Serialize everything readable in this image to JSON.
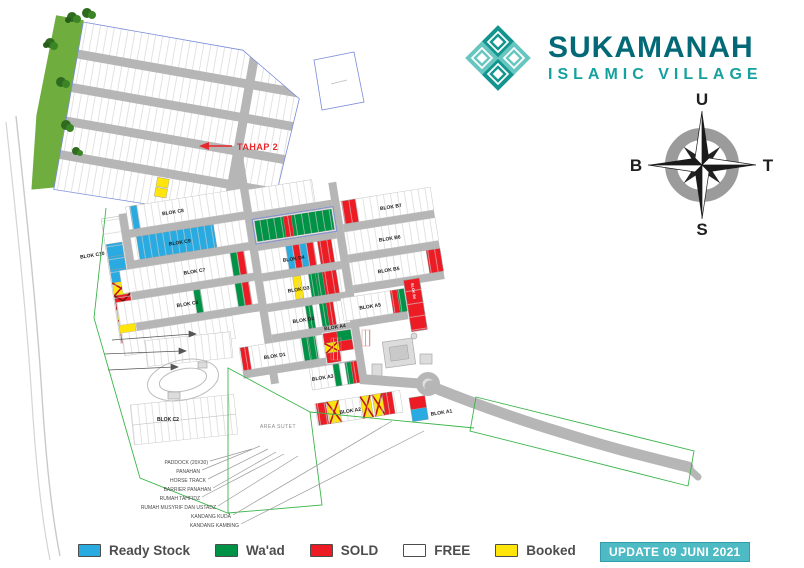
{
  "brand": {
    "name": "SUKAMANAH",
    "tagline": "ISLAMIC VILLAGE",
    "icon": "knot-icon",
    "color_dark": "#046977",
    "color_light": "#15a19e"
  },
  "compass": {
    "north": "U",
    "south": "S",
    "west": "B",
    "east": "T"
  },
  "annotations": {
    "tahap2": "TAHAP 2",
    "area_sutet": "AREA SUTET",
    "update_badge": "UPDATE 09 JUNI 2021"
  },
  "map": {
    "block_labels": [
      "BLOK C8",
      "BLOK C10",
      "BLOK C9",
      "BLOK C7",
      "BLOK C6",
      "BLOK D4",
      "BLOK D3",
      "BLOK D2",
      "BLOK D1",
      "BLOK B7",
      "BLOK B6",
      "BLOK B5",
      "BLOK B4",
      "BLOK A5",
      "BLOK A4",
      "BLOK A3",
      "BLOK A2",
      "BLOK A1",
      "BLOK C2"
    ],
    "facility_labels": [
      "PADDOCK (20X30)",
      "PANAHAN",
      "HORSE TRACK",
      "BARRIER PANAHAN",
      "RUMAH TAHFIDZ",
      "RUMAH MUSYRIF DAN USTADZ",
      "KANDANG KUDA",
      "KANDANG KAMBING"
    ]
  },
  "legend": {
    "items": [
      {
        "label": "Ready Stock",
        "color": "#29abe2"
      },
      {
        "label": "Wa'ad",
        "color": "#009245"
      },
      {
        "label": "SOLD",
        "color": "#ed1c24"
      },
      {
        "label": "FREE",
        "color": "#ffffff"
      },
      {
        "label": "Booked",
        "color": "#ffe50a"
      }
    ]
  }
}
